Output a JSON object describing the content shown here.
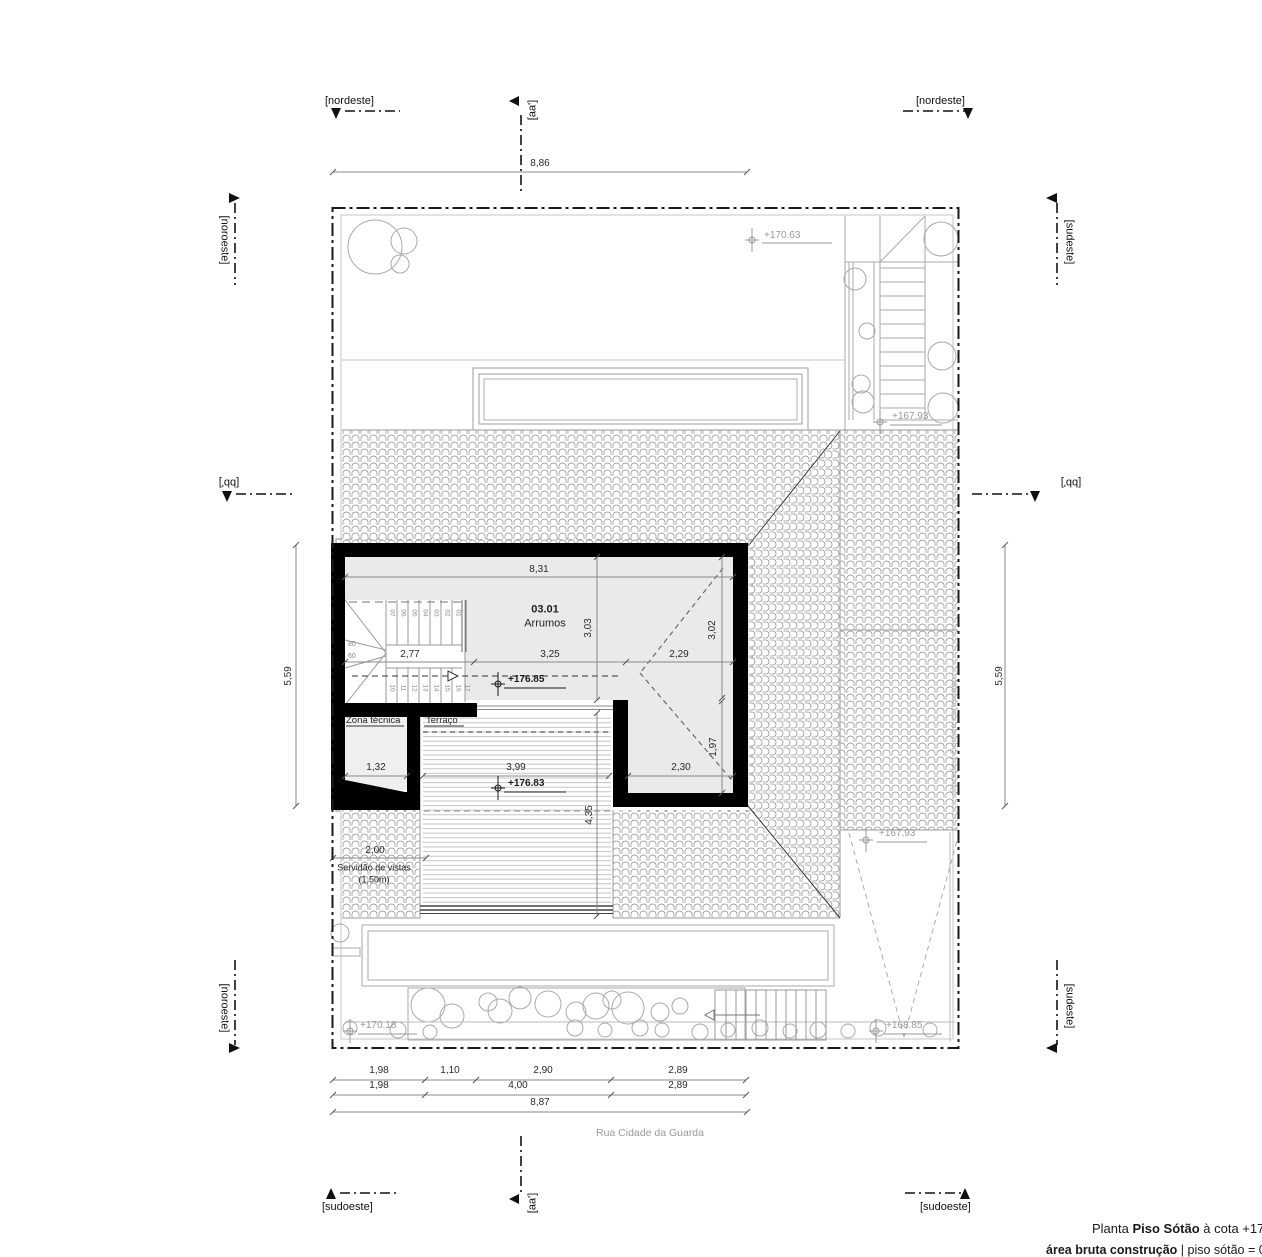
{
  "markers": {
    "nordeste_top_left": "[nordeste]",
    "nordeste_top_right": "[nordeste]",
    "noroeste_top_left": "[noroeste]",
    "sudeste_top_right": "[sudeste]",
    "bb_left": "[bb']",
    "bb_right": "[bb']",
    "noroeste_bottom_left": "[noroeste]",
    "sudeste_bottom_right": "[sudeste]",
    "sudoeste_bottom_left": "[sudoeste]",
    "sudoeste_bottom_right": "[sudoeste]",
    "aa_top": "[aa']",
    "aa_bottom": "[aa']"
  },
  "rooms": {
    "storage_number": "03.01",
    "storage_name": "Arrumos",
    "technical": "Zona técnica",
    "terrace": "Terraço"
  },
  "levels": {
    "nw_garden": "+170.63",
    "ne_stair": "+167.93",
    "storage": "+176.85",
    "terrace": "+176.83",
    "east_yard": "+167.93",
    "sw_front": "+170.18",
    "se_front": "+168.85"
  },
  "dims": {
    "top": "8,86",
    "building_top": "8,31",
    "left": "5,59",
    "right": "5,59",
    "v_storage": "3,03",
    "v_storage_r": "3,02",
    "mid": [
      "2,77",
      "3,25",
      "2,29"
    ],
    "lower": [
      "1,32",
      "3,99",
      "2,30"
    ],
    "v_terrace_r": "1,97",
    "v_terrace": "4,35",
    "easement": "2,00",
    "street_r1": [
      "1,98",
      "1,10",
      "2,90",
      "2,89"
    ],
    "street_r2": [
      "1,98",
      "4,00",
      "2,89"
    ],
    "street_total": "8,87"
  },
  "stair": {
    "upper": [
      "07",
      "06",
      "05",
      "04",
      "03",
      "02",
      "01"
    ],
    "lower": [
      "10",
      "11",
      "12",
      "13",
      "14",
      "15",
      "16",
      "17"
    ],
    "widths": [
      "80",
      "60"
    ]
  },
  "notes": {
    "easement_line1": "Servidão de vistas",
    "easement_line2": "(1,50m)",
    "fire_wall": "Parede | Cortina corta-fogo"
  },
  "street_name": "Rua Cidade da Guarda",
  "title": {
    "prefix": "Planta ",
    "name": "Piso Sótão",
    "suffix": " à cota +17",
    "line2_bold": "área bruta construção",
    "line2_rest": " | piso sótão = 03"
  }
}
